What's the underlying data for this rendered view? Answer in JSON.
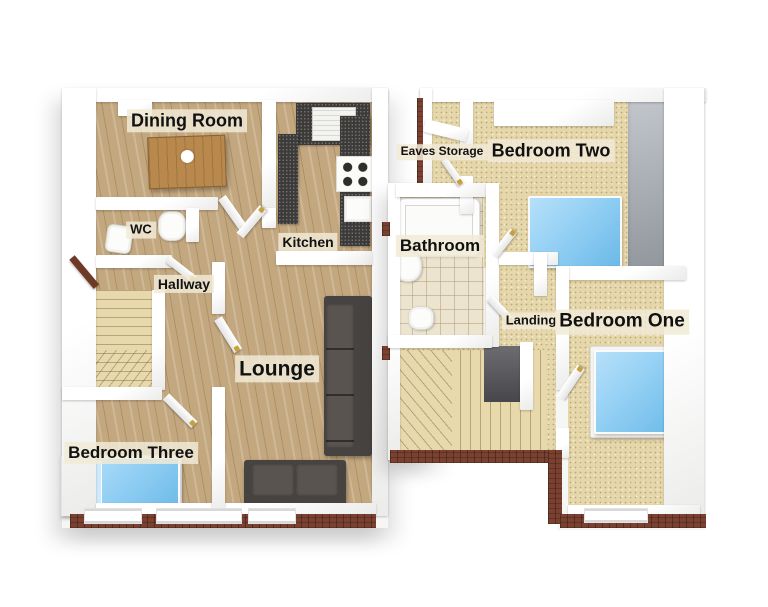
{
  "rooms": {
    "dining": {
      "label": "Dining Room"
    },
    "wc": {
      "label": "WC"
    },
    "hallway": {
      "label": "Hallway"
    },
    "kitchen": {
      "label": "Kitchen"
    },
    "lounge": {
      "label": "Lounge"
    },
    "bedroom_three": {
      "label": "Bedroom Three"
    },
    "eaves_storage": {
      "label": "Eaves Storage"
    },
    "bedroom_two": {
      "label": "Bedroom Two"
    },
    "bathroom": {
      "label": "Bathroom"
    },
    "landing": {
      "label": "Landing"
    },
    "bedroom_one": {
      "label": "Bedroom One"
    }
  },
  "furniture": [
    "dining-table",
    "kitchen-sink",
    "hob",
    "worktop",
    "toilet",
    "wash-basin",
    "staircase",
    "corner-sofa",
    "two-seat-sofa",
    "single-bed",
    "double-bed",
    "bathtub"
  ],
  "colors": {
    "background": "#ffffff",
    "wall": "#ffffff",
    "wall_shadow": "#ebebea",
    "wood_floor": "#c3a77f",
    "carpet": "#e6d7ab",
    "tile_floor": "#ede4cf",
    "worktop": "#3d3b3a",
    "bed_blue": "#8cccf2",
    "pillow_blue": "#cfeafc",
    "sofa_dark": "#474341",
    "table_wood": "#b9884d",
    "floor_slab": "#7b4130",
    "eaves_gray": "#9aa0a6",
    "stair_void": "#47474b",
    "label_background": "#f1ead6",
    "label_text": "#111111"
  }
}
